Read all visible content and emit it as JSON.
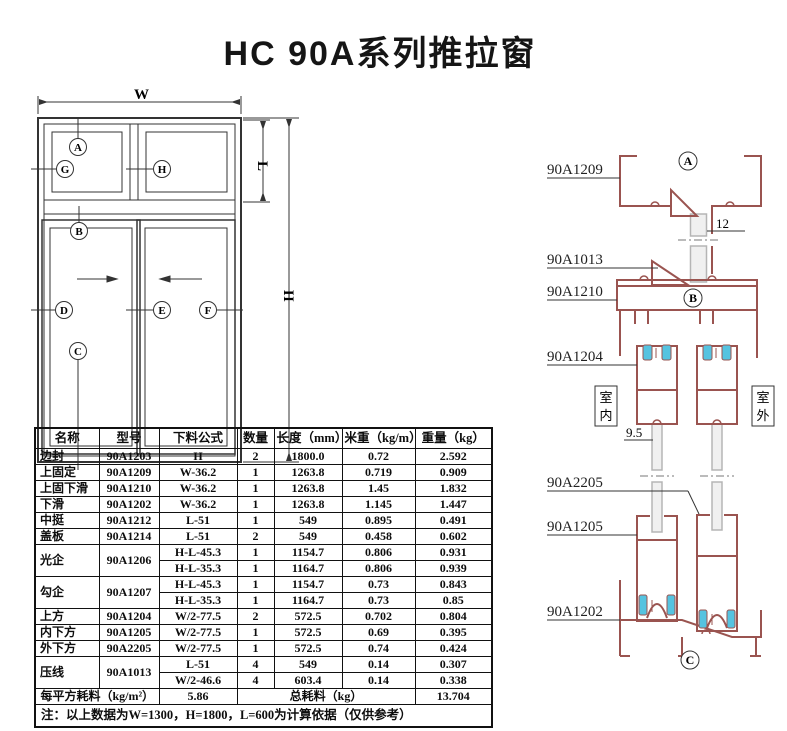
{
  "title": "HC 90A系列推拉窗",
  "window_diagram": {
    "dim_labels": {
      "w": "W",
      "l": "L",
      "h": "H"
    },
    "markers": {
      "a": "A",
      "g": "G",
      "h": "H",
      "b": "B",
      "d": "D",
      "e": "E",
      "f": "F",
      "c": "C"
    }
  },
  "profile_diagram": {
    "part_labels": {
      "p1209": "90A1209",
      "p1013": "90A1013",
      "p1210": "90A1210",
      "p1204": "90A1204",
      "p2205": "90A2205",
      "p1205": "90A1205",
      "p1202": "90A1202"
    },
    "section_markers": {
      "a": "A",
      "b": "B",
      "c": "C"
    },
    "indoor_chars": [
      "室",
      "内"
    ],
    "outdoor_chars": [
      "室",
      "外"
    ],
    "glass_dim_top": "12",
    "glass_dim_bottom": "9.5"
  },
  "colors": {
    "profile": "#9a5450",
    "roller": "#55c3e0",
    "line": "#333333",
    "glass": "#b5b5b5"
  },
  "table": {
    "headers": [
      "名称",
      "型号",
      "下料公式",
      "数量",
      "长度（mm）",
      "米重（kg/m）",
      "重量（kg）"
    ],
    "rows": [
      [
        "边封",
        "90A1203",
        "H",
        "2",
        "1800.0",
        "0.72",
        "2.592"
      ],
      [
        "上固定",
        "90A1209",
        "W-36.2",
        "1",
        "1263.8",
        "0.719",
        "0.909"
      ],
      [
        "上固下滑",
        "90A1210",
        "W-36.2",
        "1",
        "1263.8",
        "1.45",
        "1.832"
      ],
      [
        "下滑",
        "90A1202",
        "W-36.2",
        "1",
        "1263.8",
        "1.145",
        "1.447"
      ],
      [
        "中挺",
        "90A1212",
        "L-51",
        "1",
        "549",
        "0.895",
        "0.491"
      ],
      [
        "盖板",
        "90A1214",
        "L-51",
        "2",
        "549",
        "0.458",
        "0.602"
      ],
      {
        "name": "光企",
        "model": "90A1206",
        "sub": [
          [
            "H-L-45.3",
            "1",
            "1154.7",
            "0.806",
            "0.931"
          ],
          [
            "H-L-35.3",
            "1",
            "1164.7",
            "0.806",
            "0.939"
          ]
        ]
      },
      {
        "name": "勾企",
        "model": "90A1207",
        "sub": [
          [
            "H-L-45.3",
            "1",
            "1154.7",
            "0.73",
            "0.843"
          ],
          [
            "H-L-35.3",
            "1",
            "1164.7",
            "0.73",
            "0.85"
          ]
        ]
      },
      [
        "上方",
        "90A1204",
        "W/2-77.5",
        "2",
        "572.5",
        "0.702",
        "0.804"
      ],
      [
        "内下方",
        "90A1205",
        "W/2-77.5",
        "1",
        "572.5",
        "0.69",
        "0.395"
      ],
      [
        "外下方",
        "90A2205",
        "W/2-77.5",
        "1",
        "572.5",
        "0.74",
        "0.424"
      ],
      {
        "name": "压线",
        "model": "90A1013",
        "sub": [
          [
            "L-51",
            "4",
            "549",
            "0.14",
            "0.307"
          ],
          [
            "W/2-46.6",
            "4",
            "603.4",
            "0.14",
            "0.338"
          ]
        ]
      }
    ],
    "summary": {
      "label": "每平方耗料（kg/m²）",
      "value": "5.86",
      "total_label": "总耗料（kg）",
      "total_value": "13.704"
    },
    "note": "注：以上数据为W=1300，H=1800，L=600为计算依据（仅供参考）"
  }
}
